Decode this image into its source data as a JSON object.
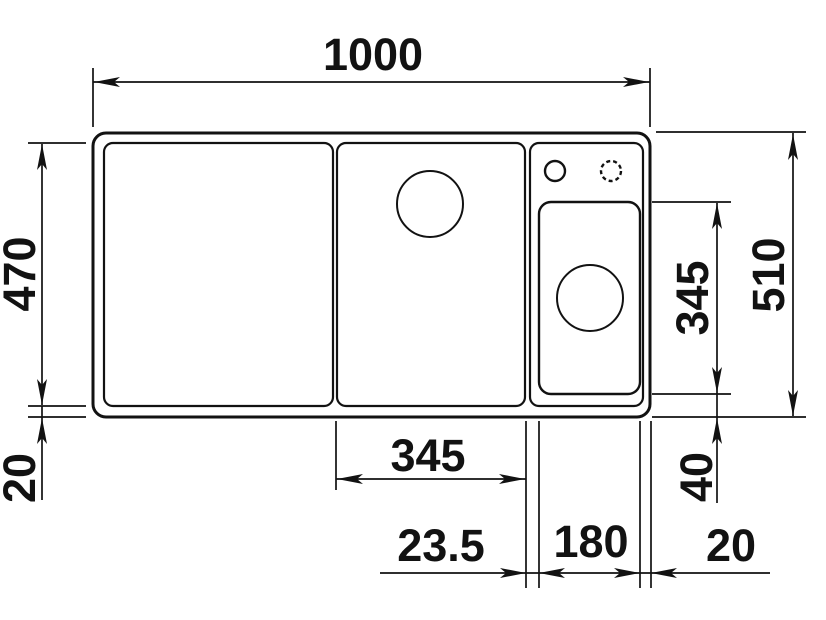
{
  "drawing": {
    "kind": "sink-installation-dimension-drawing",
    "unit": "mm",
    "line_color": "#121212",
    "background_color": "#ffffff",
    "labels": {
      "overall_width": "1000",
      "overall_depth": "510",
      "basin_inner_depth": "470",
      "left_bottom_rim": "20",
      "middle_section_width": "345",
      "divider_width": "23.5",
      "small_bowl_width": "180",
      "right_rim": "20",
      "small_bowl_depth": "345",
      "small_bowl_bottom_rim": "40"
    }
  }
}
